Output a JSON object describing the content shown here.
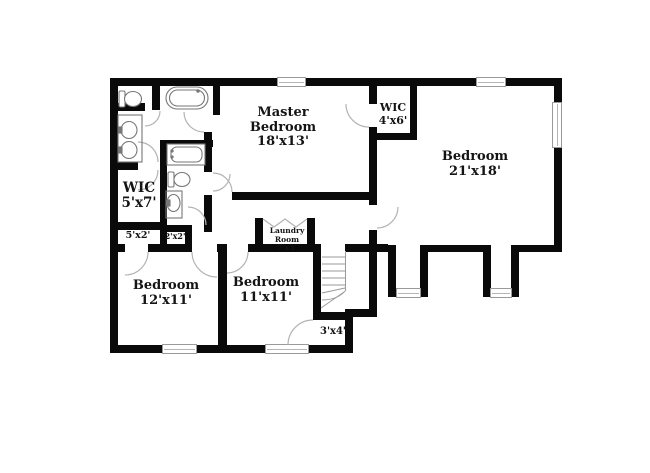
{
  "floorplan": {
    "type": "residential-floor-plan",
    "rooms": [
      {
        "name": "Master",
        "name2": "Bedroom",
        "dims": "18'x13'"
      },
      {
        "name": "WIC",
        "name2": "",
        "dims": "4'x6'"
      },
      {
        "name": "Bedroom",
        "name2": "",
        "dims": "21'x18'"
      },
      {
        "name": "WIC",
        "name2": "",
        "dims": "5'x7'"
      },
      {
        "name": "Bedroom",
        "name2": "",
        "dims": "12'x11'"
      },
      {
        "name": "Bedroom",
        "name2": "",
        "dims": "11'x11'"
      },
      {
        "name": "Laundry",
        "name2": "Room",
        "dims": "7'x3'"
      },
      {
        "name": "",
        "name2": "",
        "dims": "5'x2'"
      },
      {
        "name": "",
        "name2": "",
        "dims": "2'x2'"
      },
      {
        "name": "",
        "name2": "",
        "dims": "3'x4'"
      }
    ],
    "fixtures": [
      "toilet",
      "freestanding-bathtub",
      "double-vanity-sinks",
      "bathtub",
      "toilet",
      "vanity-sink",
      "staircase",
      "bifold-laundry-doors"
    ],
    "window_count": 7,
    "colors": {
      "wall": "#0a0a0a",
      "door_arc": "#b3b3b3",
      "fixture_line": "#777777",
      "window_frame": "#9a9a9a",
      "label_text": "#141414",
      "background": "#ffffff"
    }
  }
}
